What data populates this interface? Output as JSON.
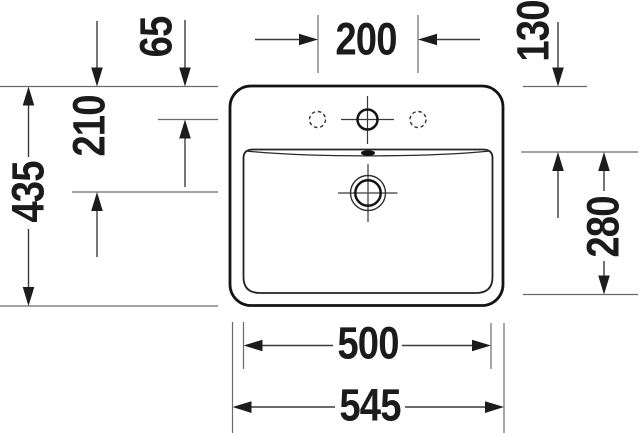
{
  "dimensions": {
    "tap_hole_spacing": "200",
    "edge_to_tap_center": "65",
    "edge_to_drain_center": "210",
    "overall_depth": "435",
    "edge_to_basin_front": "130",
    "basin_depth": "280",
    "basin_width": "500",
    "overall_width": "545"
  },
  "colors": {
    "outline": "#141414",
    "thin_line": "#4a4a4a",
    "text": "#1b1b1b",
    "background": "#ffffff"
  }
}
